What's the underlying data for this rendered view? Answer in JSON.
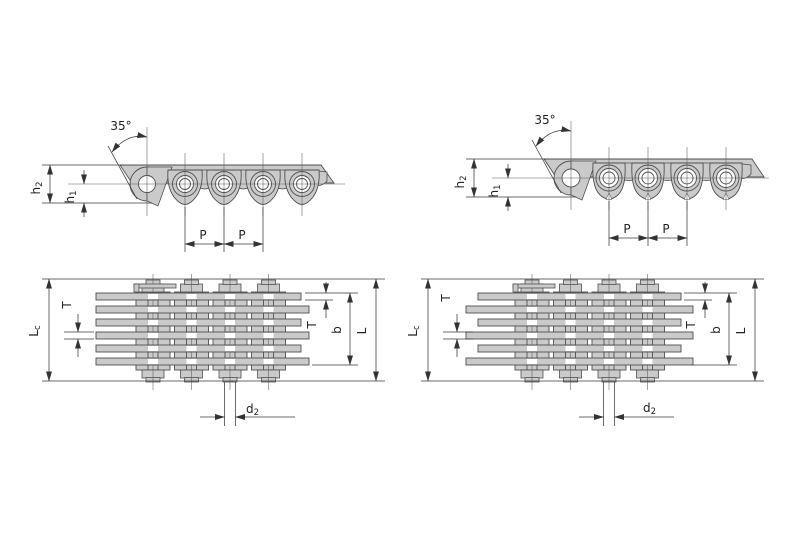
{
  "colors": {
    "background": "#ffffff",
    "metal_fill": "#cacaca",
    "outline": "#4f4f4f",
    "dimension_line": "#3a3a3a",
    "text": "#222222"
  },
  "diagrams": {
    "left": {
      "side_view": {
        "angle_label": "35°",
        "h2": {
          "base": "h",
          "sub": "2"
        },
        "h1": {
          "base": "h",
          "sub": "1"
        },
        "pitch_label_1": "P",
        "pitch_label_2": "P"
      },
      "stack_view": {
        "lc": {
          "base": "L",
          "sub": "c"
        },
        "t_left": "T",
        "t_right": "T",
        "b_label": "b",
        "l_label": "L",
        "d2": {
          "base": "d",
          "sub": "2"
        }
      }
    },
    "right": {
      "side_view": {
        "angle_label": "35°",
        "h2": {
          "base": "h",
          "sub": "2"
        },
        "h1": {
          "base": "h",
          "sub": "1"
        },
        "pitch_label_1": "P",
        "pitch_label_2": "P"
      },
      "stack_view": {
        "lc": {
          "base": "L",
          "sub": "c"
        },
        "t_left": "T",
        "t_right": "T",
        "b_label": "b",
        "l_label": "L",
        "d2": {
          "base": "d",
          "sub": "2"
        }
      }
    }
  }
}
